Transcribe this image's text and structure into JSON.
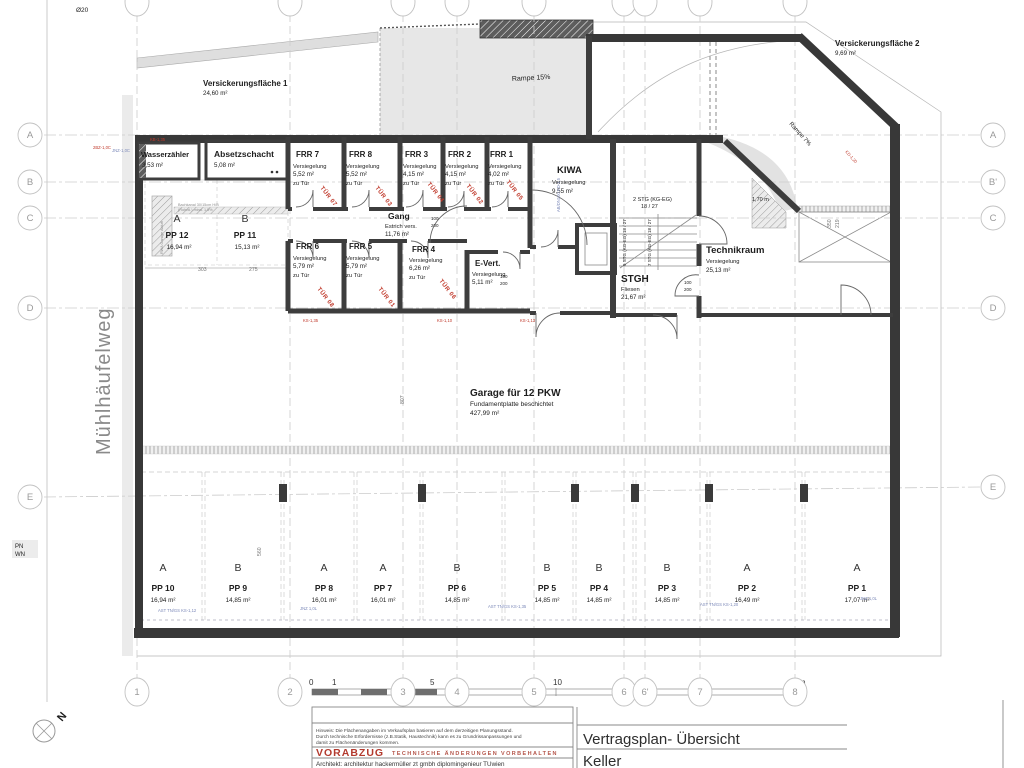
{
  "plan": {
    "street_label": "Mühlhäufelweg",
    "north_label": "N",
    "diameter_note": "Ø20",
    "pn_label": "PN",
    "wn_label": "WN",
    "versickerung1_name": "Versickerungsfläche 1",
    "versickerung1_area": "24,60 m²",
    "versickerung2_name": "Versickerungsfläche 2",
    "versickerung2_area": "9,69 m²",
    "rampe15": "Rampe 15%",
    "rampe7": "Rampe 7%",
    "dim_170": "1,70 m",
    "dim_350": "350",
    "dim_219": "219",
    "dim_303": "303",
    "dim_275": "275",
    "dim_807": "807",
    "dim_560": "560",
    "door_w": "100",
    "door_h": "200"
  },
  "rooms": {
    "wasserzaehler": {
      "name": "Wasserzähler",
      "area": "3,53 m²"
    },
    "absetzschacht": {
      "name": "Absetzschacht",
      "area": "5,08 m²"
    },
    "frr7": {
      "name": "FRR 7",
      "sub": "Versiegelung",
      "area": "5,52 m²",
      "note": "zu Tür"
    },
    "frr8": {
      "name": "FRR 8",
      "sub": "Versiegelung",
      "area": "5,52 m²",
      "note": "zu Tür"
    },
    "frr3": {
      "name": "FRR 3",
      "sub": "Versiegelung",
      "area": "4,15 m²",
      "note": "zu Tür"
    },
    "frr2": {
      "name": "FRR 2",
      "sub": "Versiegelung",
      "area": "4,15 m²",
      "note": "zu Tür"
    },
    "frr1": {
      "name": "FRR 1",
      "sub": "Versiegelung",
      "area": "4,02 m²",
      "note": "zu Tür"
    },
    "kiwa": {
      "name": "KIWA",
      "sub": "Versiegelung",
      "area": "9,55 m²"
    },
    "gang": {
      "name": "Gang",
      "sub": "Estrich vers.",
      "area": "11,76 m²"
    },
    "frr6": {
      "name": "FRR 6",
      "sub": "Versiegelung",
      "area": "5,79 m²",
      "note": "zu Tür"
    },
    "frr5": {
      "name": "FRR 5",
      "sub": "Versiegelung",
      "area": "5,79 m²",
      "note": "zu Tür"
    },
    "frr4": {
      "name": "FRR 4",
      "sub": "Versiegelung",
      "area": "6,26 m²",
      "note": "zu Tür"
    },
    "evert": {
      "name": "E-Vert.",
      "sub": "Versiegelung",
      "area": "5,11 m²"
    },
    "stgh": {
      "name": "STGH",
      "sub": "Fliesen",
      "area": "21,67 m²"
    },
    "technikraum": {
      "name": "Technikraum",
      "sub": "Versiegelung",
      "area": "25,13 m²"
    }
  },
  "stairs": {
    "top": "2 STG (KG-EG)",
    "top2": "18 / 27",
    "flight9": "9 STG (KG-EG) 18 / 27",
    "flight7": "7 STG (KG-EG) 18 / 27"
  },
  "garage": {
    "name": "Garage für 12 PKW",
    "sub": "Fundamentplatte beschichtet",
    "area": "427,99 m²"
  },
  "parking": [
    {
      "id": "PP 12",
      "type": "A",
      "area": "16,94 m²"
    },
    {
      "id": "PP 11",
      "type": "B",
      "area": "15,13 m²"
    },
    {
      "id": "PP 10",
      "type": "A",
      "area": "16,94 m²"
    },
    {
      "id": "PP 9",
      "type": "B",
      "area": "14,85 m²"
    },
    {
      "id": "PP 8",
      "type": "A",
      "area": "16,01 m²"
    },
    {
      "id": "PP 7",
      "type": "A",
      "area": "16,01 m²"
    },
    {
      "id": "PP 6",
      "type": "B",
      "area": "14,85 m²"
    },
    {
      "id": "PP 5",
      "type": "B",
      "area": "14,85 m²"
    },
    {
      "id": "PP 4",
      "type": "B",
      "area": "14,85 m²"
    },
    {
      "id": "PP 3",
      "type": "B",
      "area": "14,85 m²"
    },
    {
      "id": "PP 2",
      "type": "A",
      "area": "16,49 m²"
    },
    {
      "id": "PP 1",
      "type": "A",
      "area": "17,07 m²"
    }
  ],
  "tuer": [
    "TÜR 07",
    "TÜR 03",
    "TÜR 04",
    "TÜR 02",
    "TÜR 05",
    "TÜR 08",
    "TÜR 01",
    "TÜR 06"
  ],
  "grid": {
    "left": [
      "A",
      "B",
      "C",
      "D",
      "E"
    ],
    "right": [
      "A",
      "B'",
      "C",
      "D",
      "E"
    ],
    "bottom": [
      "1",
      "2",
      "3",
      "4",
      "5",
      "6",
      "6'",
      "7",
      "8"
    ]
  },
  "scale": [
    "0",
    "1",
    "5",
    "10",
    "20m"
  ],
  "annotations": {
    "duct1": "Bachkanal 30/15cm H/B",
    "duct2": "(Rohrkl.) mind. 1,5%",
    "rwa": "RWA Garage Abluft",
    "red1": "KB-1,35",
    "red2": "2BZ-1,0C",
    "red3": "KS-1,35",
    "red4": "KS-1,13",
    "red5": "KS-1,10",
    "red6": "KD-1,20",
    "blue1": "JNZ-1,0C",
    "blue2": "JNZ 1,0L",
    "blue3": "AST TN/GS KS-1,35",
    "blue4": "AST TN/GS KS-1,20",
    "blue5": "AST TN/GS KS-1,12",
    "blue6": "JNZ 1,0L",
    "blue7": "AB/DN100 KD-1,5"
  },
  "title_block": {
    "hinweis1": "Hinweis: Die Flächenangaben im Verkaufsplan basieren auf dem derzeitigen Planungsstand.",
    "hinweis2": "Durch technische Erfordernisse (z.B.Statik, Haustechnik) kann es zu  Grundrissanpassungen und",
    "hinweis3": "damit zu Flächenänderungen kommen.",
    "vorabzug": "VORABZUG",
    "vorbehalt": "TECHNISCHE ÄNDERUNGEN VORBEHALTEN",
    "architekt": "Architekt:   architektur hackermüller zt gmbh diplomingenieur TUwien",
    "plan_title": "Vertragsplan- Übersicht",
    "plan_subtitle": "Keller"
  }
}
